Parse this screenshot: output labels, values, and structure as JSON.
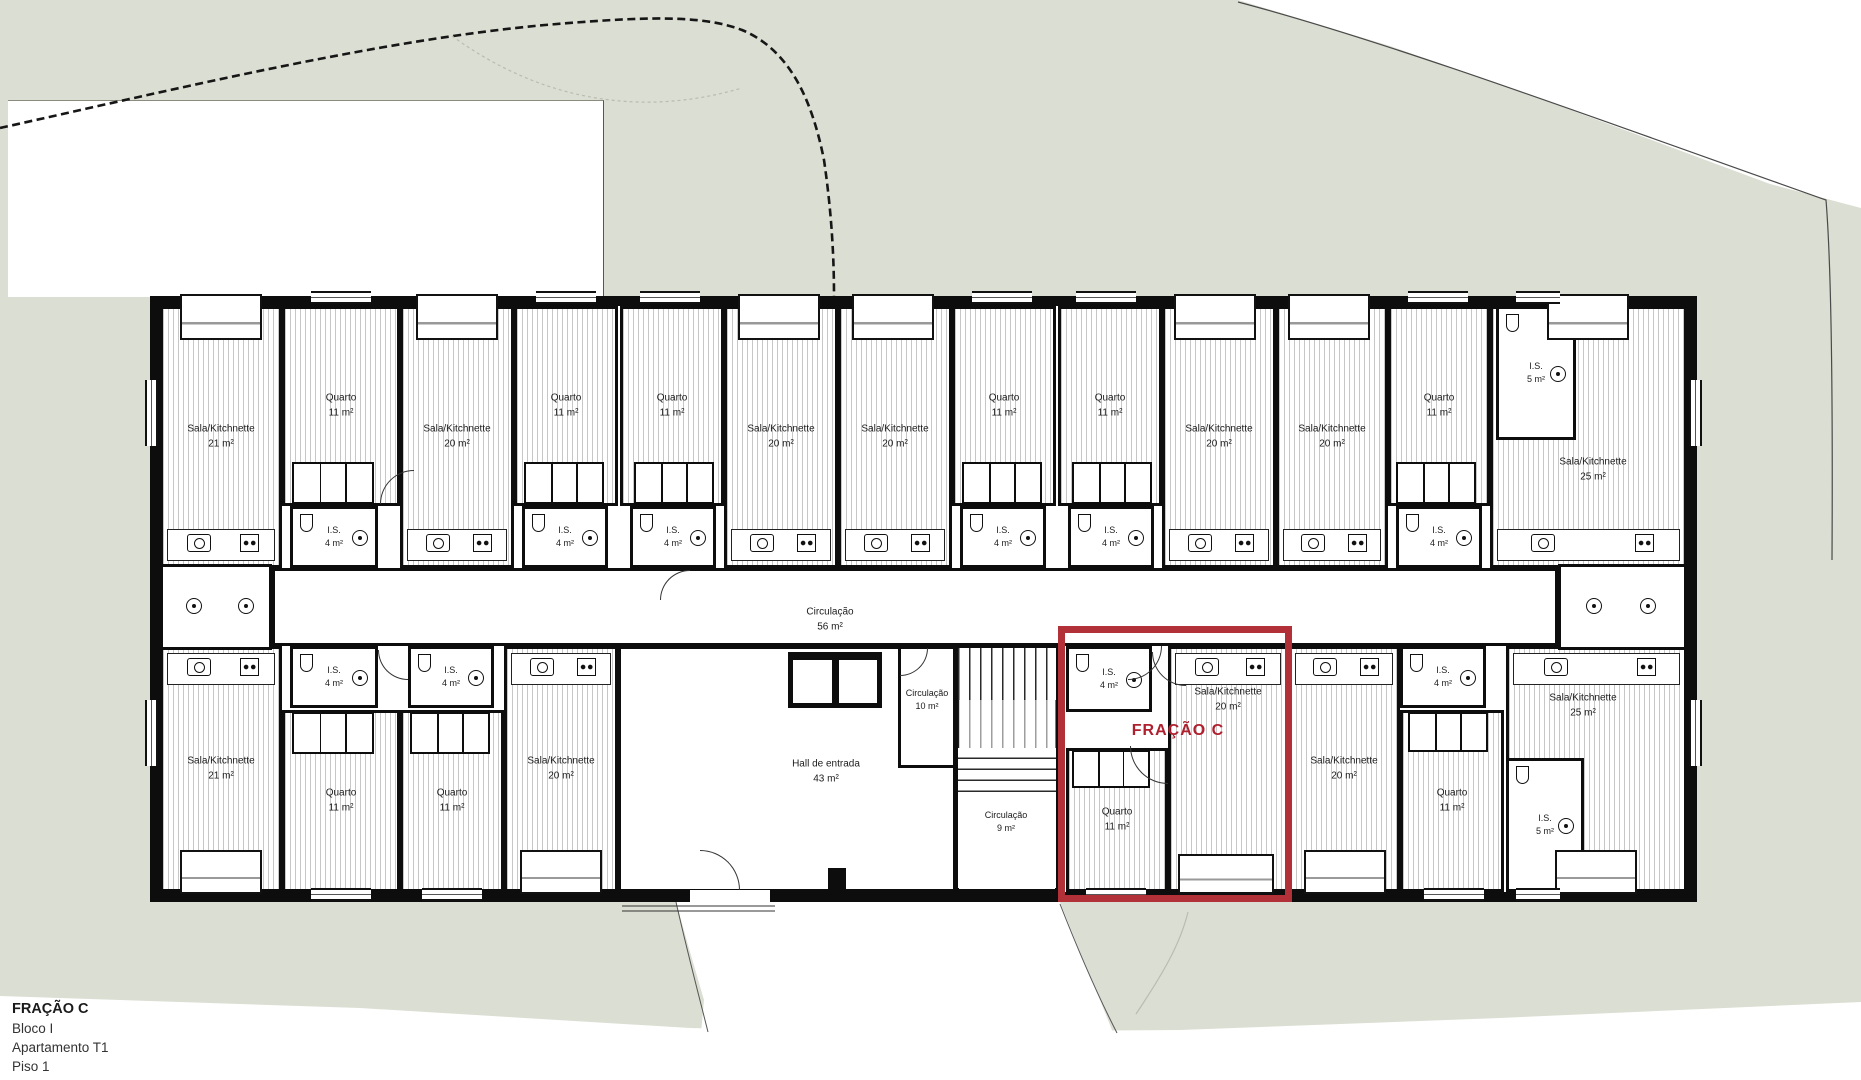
{
  "colors": {
    "site_green": "#dbded2",
    "wall": "#0d0d0d",
    "accent": "#b23139",
    "accent_text": "#b01f2e",
    "hatch": "#c7c7c7"
  },
  "title_block": {
    "fraction": "FRAÇÃO C",
    "block": "Bloco I",
    "apartment": "Apartamento T1",
    "floor": "Piso 1"
  },
  "highlight": {
    "label": "FRAÇÃO C",
    "x": 1058,
    "y": 626,
    "w": 234,
    "h": 276,
    "label_x": 1178,
    "label_y": 731
  },
  "rooms": [
    {
      "id": "sala-t1",
      "type": "sala",
      "x": 160,
      "y": 306,
      "w": 122,
      "h": 262,
      "label": [
        "Sala/Kitchnette",
        "21 m²"
      ],
      "counter": "bottom"
    },
    {
      "id": "quarto-t1",
      "type": "quarto",
      "x": 282,
      "y": 306,
      "w": 118,
      "h": 200,
      "label": [
        "Quarto",
        "11 m²"
      ]
    },
    {
      "id": "closet-t1",
      "type": "closet",
      "x": 292,
      "y": 462,
      "w": 82,
      "h": 42
    },
    {
      "id": "is-t1",
      "type": "is",
      "x": 290,
      "y": 506,
      "w": 88,
      "h": 62,
      "label": [
        "I.S.",
        "4 m²"
      ],
      "small": true
    },
    {
      "id": "sala-t2",
      "type": "sala",
      "x": 400,
      "y": 306,
      "w": 114,
      "h": 262,
      "label": [
        "Sala/Kitchnette",
        "20 m²"
      ],
      "counter": "bottom"
    },
    {
      "id": "quarto-t2",
      "type": "quarto",
      "x": 514,
      "y": 306,
      "w": 104,
      "h": 200,
      "label": [
        "Quarto",
        "11 m²"
      ]
    },
    {
      "id": "closet-t2",
      "type": "closet",
      "x": 524,
      "y": 462,
      "w": 80,
      "h": 42
    },
    {
      "id": "is-t2",
      "type": "is",
      "x": 522,
      "y": 506,
      "w": 86,
      "h": 62,
      "label": [
        "I.S.",
        "4 m²"
      ],
      "small": true
    },
    {
      "id": "quarto-t3",
      "type": "quarto",
      "x": 620,
      "y": 306,
      "w": 104,
      "h": 200,
      "label": [
        "Quarto",
        "11 m²"
      ]
    },
    {
      "id": "closet-t3",
      "type": "closet",
      "x": 634,
      "y": 462,
      "w": 80,
      "h": 42
    },
    {
      "id": "is-t3",
      "type": "is",
      "x": 630,
      "y": 506,
      "w": 86,
      "h": 62,
      "label": [
        "I.S.",
        "4 m²"
      ],
      "small": true
    },
    {
      "id": "sala-t3",
      "type": "sala",
      "x": 724,
      "y": 306,
      "w": 114,
      "h": 262,
      "label": [
        "Sala/Kitchnette",
        "20 m²"
      ],
      "counter": "bottom"
    },
    {
      "id": "sala-t4",
      "type": "sala",
      "x": 838,
      "y": 306,
      "w": 114,
      "h": 262,
      "label": [
        "Sala/Kitchnette",
        "20 m²"
      ],
      "counter": "bottom"
    },
    {
      "id": "quarto-t4",
      "type": "quarto",
      "x": 952,
      "y": 306,
      "w": 104,
      "h": 200,
      "label": [
        "Quarto",
        "11 m²"
      ]
    },
    {
      "id": "closet-t4",
      "type": "closet",
      "x": 962,
      "y": 462,
      "w": 80,
      "h": 42
    },
    {
      "id": "is-t4",
      "type": "is",
      "x": 960,
      "y": 506,
      "w": 86,
      "h": 62,
      "label": [
        "I.S.",
        "4 m²"
      ],
      "small": true
    },
    {
      "id": "quarto-t5",
      "type": "quarto",
      "x": 1058,
      "y": 306,
      "w": 104,
      "h": 200,
      "label": [
        "Quarto",
        "11 m²"
      ]
    },
    {
      "id": "closet-t5",
      "type": "closet",
      "x": 1072,
      "y": 462,
      "w": 80,
      "h": 42
    },
    {
      "id": "is-t5",
      "type": "is",
      "x": 1068,
      "y": 506,
      "w": 86,
      "h": 62,
      "label": [
        "I.S.",
        "4 m²"
      ],
      "small": true
    },
    {
      "id": "sala-t5",
      "type": "sala",
      "x": 1162,
      "y": 306,
      "w": 114,
      "h": 262,
      "label": [
        "Sala/Kitchnette",
        "20 m²"
      ],
      "counter": "bottom"
    },
    {
      "id": "sala-t6",
      "type": "sala",
      "x": 1276,
      "y": 306,
      "w": 112,
      "h": 262,
      "label": [
        "Sala/Kitchnette",
        "20 m²"
      ],
      "counter": "bottom"
    },
    {
      "id": "quarto-t6",
      "type": "quarto",
      "x": 1388,
      "y": 306,
      "w": 102,
      "h": 200,
      "label": [
        "Quarto",
        "11 m²"
      ]
    },
    {
      "id": "closet-t6",
      "type": "closet",
      "x": 1396,
      "y": 462,
      "w": 80,
      "h": 42
    },
    {
      "id": "is-t6",
      "type": "is",
      "x": 1396,
      "y": 506,
      "w": 86,
      "h": 62,
      "label": [
        "I.S.",
        "4 m²"
      ],
      "small": true
    },
    {
      "id": "sala-t7",
      "type": "sala",
      "x": 1490,
      "y": 306,
      "w": 197,
      "h": 262,
      "label": [
        "Sala/Kitchnette",
        "25 m²"
      ],
      "counter": "bottom",
      "lpos": [
        1593,
        470
      ]
    },
    {
      "id": "is5-t",
      "type": "is",
      "x": 1496,
      "y": 306,
      "w": 80,
      "h": 134,
      "label": [
        "I.S.",
        "5 m²"
      ],
      "small": true
    },
    {
      "id": "corridor",
      "type": "circ",
      "x": 272,
      "y": 568,
      "w": 1286,
      "h": 78,
      "label": [
        "Circulação",
        "56 m²"
      ],
      "lpos": [
        830,
        620
      ]
    },
    {
      "id": "util-left",
      "type": "util",
      "x": 160,
      "y": 564,
      "w": 112,
      "h": 86
    },
    {
      "id": "util-right",
      "type": "util",
      "x": 1558,
      "y": 564,
      "w": 129,
      "h": 86
    },
    {
      "id": "sala-b1",
      "type": "sala",
      "x": 160,
      "y": 646,
      "w": 122,
      "h": 246,
      "label": [
        "Sala/Kitchnette",
        "21 m²"
      ],
      "counter": "top"
    },
    {
      "id": "is-b1",
      "type": "is",
      "x": 290,
      "y": 646,
      "w": 88,
      "h": 62,
      "label": [
        "I.S.",
        "4 m²"
      ],
      "small": true
    },
    {
      "id": "quarto-b1",
      "type": "quarto",
      "x": 282,
      "y": 710,
      "w": 118,
      "h": 182,
      "label": [
        "Quarto",
        "11 m²"
      ]
    },
    {
      "id": "closet-b1",
      "type": "closet",
      "x": 292,
      "y": 712,
      "w": 82,
      "h": 42
    },
    {
      "id": "is-b2",
      "type": "is",
      "x": 408,
      "y": 646,
      "w": 86,
      "h": 62,
      "label": [
        "I.S.",
        "4 m²"
      ],
      "small": true
    },
    {
      "id": "quarto-b2",
      "type": "quarto",
      "x": 400,
      "y": 710,
      "w": 104,
      "h": 182,
      "label": [
        "Quarto",
        "11 m²"
      ]
    },
    {
      "id": "closet-b2",
      "type": "closet",
      "x": 410,
      "y": 712,
      "w": 80,
      "h": 42
    },
    {
      "id": "sala-b2",
      "type": "sala",
      "x": 504,
      "y": 646,
      "w": 114,
      "h": 246,
      "label": [
        "Sala/Kitchnette",
        "20 m²"
      ],
      "counter": "top"
    },
    {
      "id": "hall",
      "type": "hall",
      "x": 618,
      "y": 646,
      "w": 338,
      "h": 246,
      "label": [
        "Hall de entrada",
        "43 m²"
      ],
      "lpos": [
        826,
        772
      ]
    },
    {
      "id": "circ10",
      "type": "circ",
      "x": 898,
      "y": 646,
      "w": 58,
      "h": 122,
      "label": [
        "Circulação",
        "10 m²"
      ],
      "small": true,
      "lpos": [
        927,
        700
      ]
    },
    {
      "id": "stairwell",
      "type": "plainbox",
      "x": 956,
      "y": 646,
      "w": 102,
      "h": 246
    },
    {
      "id": "circ9",
      "type": "plain",
      "x": 958,
      "y": 792,
      "w": 98,
      "h": 96,
      "label": [
        "Circulação",
        "9 m²"
      ],
      "small": true,
      "lpos": [
        1006,
        822
      ]
    },
    {
      "id": "is-fc",
      "type": "is",
      "x": 1066,
      "y": 646,
      "w": 86,
      "h": 66,
      "label": [
        "I.S.",
        "4 m²"
      ],
      "small": true
    },
    {
      "id": "quarto-fc",
      "type": "quarto",
      "x": 1066,
      "y": 748,
      "w": 102,
      "h": 144,
      "label": [
        "Quarto",
        "11 m²"
      ]
    },
    {
      "id": "closet-fc",
      "type": "closet",
      "x": 1072,
      "y": 750,
      "w": 78,
      "h": 38
    },
    {
      "id": "sala-fc",
      "type": "sala",
      "x": 1168,
      "y": 646,
      "w": 120,
      "h": 246,
      "label": [
        "Sala/Kitchnette",
        "20 m²"
      ],
      "counter": "top",
      "lpos": [
        1228,
        700
      ]
    },
    {
      "id": "sala-b3",
      "type": "sala",
      "x": 1288,
      "y": 646,
      "w": 112,
      "h": 246,
      "label": [
        "Sala/Kitchnette",
        "20 m²"
      ],
      "counter": "top"
    },
    {
      "id": "is-b3",
      "type": "is",
      "x": 1400,
      "y": 646,
      "w": 86,
      "h": 62,
      "label": [
        "I.S.",
        "4 m²"
      ],
      "small": true
    },
    {
      "id": "quarto-b3",
      "type": "quarto",
      "x": 1400,
      "y": 710,
      "w": 104,
      "h": 182,
      "label": [
        "Quarto",
        "11 m²"
      ]
    },
    {
      "id": "closet-b3",
      "type": "closet",
      "x": 1408,
      "y": 712,
      "w": 80,
      "h": 40
    },
    {
      "id": "sala-b4",
      "type": "sala",
      "x": 1506,
      "y": 646,
      "w": 181,
      "h": 246,
      "label": [
        "Sala/Kitchnette",
        "25 m²"
      ],
      "counter": "top",
      "lpos": [
        1583,
        706
      ]
    },
    {
      "id": "is5-b",
      "type": "is",
      "x": 1506,
      "y": 758,
      "w": 78,
      "h": 134,
      "label": [
        "I.S.",
        "5 m²"
      ],
      "small": true
    }
  ],
  "stairs": [
    {
      "id": "flight-up",
      "x": 958,
      "y": 648,
      "w": 98,
      "h": 52,
      "dir": "v"
    },
    {
      "id": "flight-mid",
      "x": 958,
      "y": 700,
      "w": 98,
      "h": 48,
      "dir": "v",
      "dashed": true
    },
    {
      "id": "flight-low",
      "x": 958,
      "y": 748,
      "w": 98,
      "h": 44,
      "dir": "h"
    }
  ],
  "lift": {
    "x": 788,
    "y": 652,
    "w": 94,
    "h": 56
  },
  "windows": [
    {
      "x": 311,
      "y": 291,
      "w": 60,
      "h": 13,
      "o": "h"
    },
    {
      "x": 536,
      "y": 291,
      "w": 60,
      "h": 13,
      "o": "h"
    },
    {
      "x": 640,
      "y": 291,
      "w": 60,
      "h": 13,
      "o": "h"
    },
    {
      "x": 972,
      "y": 291,
      "w": 60,
      "h": 13,
      "o": "h"
    },
    {
      "x": 1076,
      "y": 291,
      "w": 60,
      "h": 13,
      "o": "h"
    },
    {
      "x": 1408,
      "y": 291,
      "w": 60,
      "h": 13,
      "o": "h"
    },
    {
      "x": 1516,
      "y": 291,
      "w": 44,
      "h": 13,
      "o": "h"
    },
    {
      "x": 311,
      "y": 888,
      "w": 60,
      "h": 13,
      "o": "h"
    },
    {
      "x": 422,
      "y": 888,
      "w": 60,
      "h": 13,
      "o": "h"
    },
    {
      "x": 1086,
      "y": 888,
      "w": 60,
      "h": 13,
      "o": "h"
    },
    {
      "x": 1424,
      "y": 888,
      "w": 60,
      "h": 13,
      "o": "h"
    },
    {
      "x": 1516,
      "y": 888,
      "w": 44,
      "h": 13,
      "o": "h"
    },
    {
      "x": 145,
      "y": 380,
      "w": 13,
      "h": 66,
      "o": "v"
    },
    {
      "x": 145,
      "y": 700,
      "w": 13,
      "h": 66,
      "o": "v"
    },
    {
      "x": 1689,
      "y": 380,
      "w": 13,
      "h": 66,
      "o": "v"
    },
    {
      "x": 1689,
      "y": 700,
      "w": 13,
      "h": 66,
      "o": "v"
    },
    {
      "x": 690,
      "y": 890,
      "w": 80,
      "h": 12,
      "o": "gap"
    }
  ],
  "niches": [
    {
      "x": 180,
      "y": 294,
      "w": 82,
      "h": 46
    },
    {
      "x": 416,
      "y": 294,
      "w": 82,
      "h": 46
    },
    {
      "x": 738,
      "y": 294,
      "w": 82,
      "h": 46
    },
    {
      "x": 852,
      "y": 294,
      "w": 82,
      "h": 46
    },
    {
      "x": 1174,
      "y": 294,
      "w": 82,
      "h": 46
    },
    {
      "x": 1288,
      "y": 294,
      "w": 82,
      "h": 46
    },
    {
      "x": 1547,
      "y": 294,
      "w": 82,
      "h": 46
    },
    {
      "x": 180,
      "y": 850,
      "w": 82,
      "h": 44
    },
    {
      "x": 520,
      "y": 850,
      "w": 82,
      "h": 44
    },
    {
      "x": 1178,
      "y": 854,
      "w": 96,
      "h": 40
    },
    {
      "x": 1304,
      "y": 850,
      "w": 82,
      "h": 44
    },
    {
      "x": 1555,
      "y": 850,
      "w": 82,
      "h": 44
    }
  ],
  "doors": [
    {
      "x": 1152,
      "y": 652,
      "r": 34,
      "o": "bl"
    },
    {
      "x": 1130,
      "y": 746,
      "r": 38,
      "o": "bl"
    },
    {
      "x": 1128,
      "y": 646,
      "r": 34,
      "o": "br"
    },
    {
      "x": 700,
      "y": 850,
      "r": 40,
      "o": "tr"
    },
    {
      "x": 900,
      "y": 648,
      "r": 28,
      "o": "br"
    },
    {
      "x": 660,
      "y": 570,
      "r": 30,
      "o": "tl"
    },
    {
      "x": 378,
      "y": 650,
      "r": 30,
      "o": "bl"
    },
    {
      "x": 380,
      "y": 470,
      "r": 34,
      "o": "tl"
    }
  ],
  "fixtures": [
    {
      "t": "circle",
      "x": 186,
      "y": 598
    },
    {
      "t": "circle",
      "x": 238,
      "y": 598
    },
    {
      "t": "circle",
      "x": 1586,
      "y": 598
    },
    {
      "t": "circle",
      "x": 1640,
      "y": 598
    },
    {
      "t": "col",
      "x": 828,
      "y": 868,
      "w": 18,
      "h": 26
    }
  ]
}
